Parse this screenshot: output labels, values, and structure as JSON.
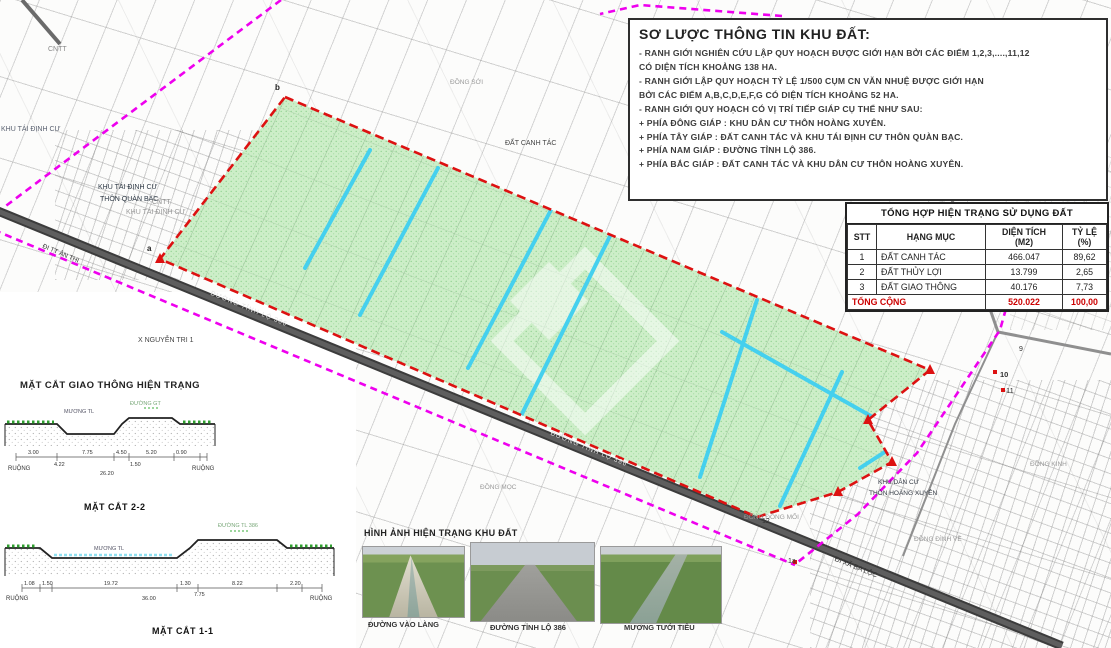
{
  "info_panel": {
    "title": "SƠ LƯỢC THÔNG TIN KHU ĐẤT:",
    "lines": [
      "- RANH GIỚI NGHIÊN CỨU LẬP QUY HOẠCH ĐƯỢC GIỚI HẠN BỞI CÁC ĐIỂM 1,2,3,....,11,12",
      "CÓ DIỆN TÍCH KHOẢNG 138 HA.",
      "- RANH GIỚI LẬP QUY HOẠCH TỶ LỆ 1/500 CỤM CN VĂN NHUỆ ĐƯỢC GIỚI HẠN",
      "BỞI CÁC ĐIỂM A,B,C,D,E,F,G CÓ DIỆN TÍCH KHOẢNG 52 HA.",
      "- RANH GIỚI QUY HOẠCH CÓ VỊ TRÍ TIẾP GIÁP CỤ THỂ NHƯ SAU:",
      "+ PHÍA ĐÔNG GIÁP :  KHU DÂN CƯ THÔN HOÀNG XUYÊN.",
      "+ PHÍA TÂY GIÁP    :  ĐẤT CANH TÁC VÀ KHU TÁI ĐỊNH CƯ THÔN QUÀN BẠC.",
      "+ PHÍA NAM GIÁP  :  ĐƯỜNG TỈNH LỘ 386.",
      "+ PHÍA BẮC GIÁP   :  ĐẤT CANH TÁC VÀ KHU DÂN CƯ THÔN HOÀNG XUYÊN."
    ]
  },
  "land_use_table": {
    "title": "TỔNG HỢP HIỆN TRẠNG SỬ DỤNG ĐẤT",
    "headers": [
      "STT",
      "HẠNG MỤC",
      "DIỆN TÍCH\n(M2)",
      "TỶ LỆ\n(%)"
    ],
    "rows": [
      [
        "1",
        "ĐẤT CANH TÁC",
        "466.047",
        "89,62"
      ],
      [
        "2",
        "ĐẤT THỦY LỢI",
        "13.799",
        "2,65"
      ],
      [
        "3",
        "ĐẤT GIAO THÔNG",
        "40.176",
        "7,73"
      ]
    ],
    "total": {
      "label": "TỔNG CỘNG",
      "area": "520.022",
      "ratio": "100,00"
    }
  },
  "cross_sections": {
    "heading": "MẶT CẮT GIAO THÔNG HIỆN TRẠNG",
    "s22": {
      "caption": "MẶT CẮT 2-2",
      "road_label": "ĐƯỜNG GT",
      "canal_label": "MƯƠNG TL",
      "left_field": "RUỘNG",
      "right_field": "RUỘNG",
      "dims_top": [
        "3.00",
        "7.75",
        "4.50",
        "5.20",
        "0.90"
      ],
      "dims_mid": [
        "4.22",
        "1.50"
      ],
      "total": "26.20"
    },
    "s11": {
      "caption": "MẶT CẮT 1-1",
      "road_label": "ĐƯỜNG TL 386",
      "canal_label": "MƯƠNG TL",
      "left_field": "RUỘNG",
      "right_field": "RUỘNG",
      "dims_top": [
        "1.08",
        "1.50",
        "19.72",
        "1.30",
        "8.22",
        "2.20"
      ],
      "dims_mid": [
        "36.00",
        "7.75"
      ]
    }
  },
  "photos": {
    "heading": "HÌNH ẢNH HIỆN TRẠNG KHU ĐẤT",
    "items": [
      {
        "caption": "ĐƯỜNG VÀO LÀNG"
      },
      {
        "caption": "ĐƯỜNG TỈNH LỘ 386"
      },
      {
        "caption": "MƯƠNG TƯỚI TIÊU"
      }
    ]
  },
  "map": {
    "labels": {
      "cntt_topleft": "CNTT",
      "tdc_far_left": "KHU TÁI ĐỊNH CƯ",
      "khu_tdc": "KHU TÁI ĐỊNH CƯ",
      "thon_quan_bac": "THÔN QUÀN BẠC",
      "cntt2": "CNTT",
      "khu_tdc2": "KHU TÁI ĐỊNH CƯ",
      "x_nguyen_tri": "X  NGUYỄN TRI 1",
      "dat_canh_tac": "ĐẤT CANH TÁC",
      "dong_soi": "ĐỒNG SỚI",
      "dong_moc": "ĐỒNG MỌC",
      "dong_dong_moi": "ĐỒNG ĐỒNG MỐI",
      "khu_dan_cu": "KHU DÂN CƯ",
      "thon_hoang_xuyen": "THÔN HOÀNG XUYÊN",
      "dong_dinh_ve": "ĐỒNG ĐÌNH VỀ",
      "dong_kinh": "ĐỒNG KINH",
      "di_xa_ba_loc": "ĐI XÃ BA LỘC",
      "di_tt_an_thi": "ĐI TT ÂN THI",
      "road386_a": "ĐƯỜNG TỈNH LỘ 386",
      "road386_b": "ĐƯỜNG TỈNH LỘ 386",
      "pt_b": "b",
      "pt_a": "a",
      "pt_9": "9",
      "pt_10": "10",
      "pt_11": "11",
      "pt_12": "12",
      "pt_1a": "1a"
    }
  },
  "colors": {
    "study_boundary": "#ee00ee",
    "planning_boundary": "#dd1111",
    "planning_area_fill": "#cdeec8",
    "canal": "#45d0ee",
    "road": "#4a4a4a",
    "total_row": "#cc0000"
  }
}
